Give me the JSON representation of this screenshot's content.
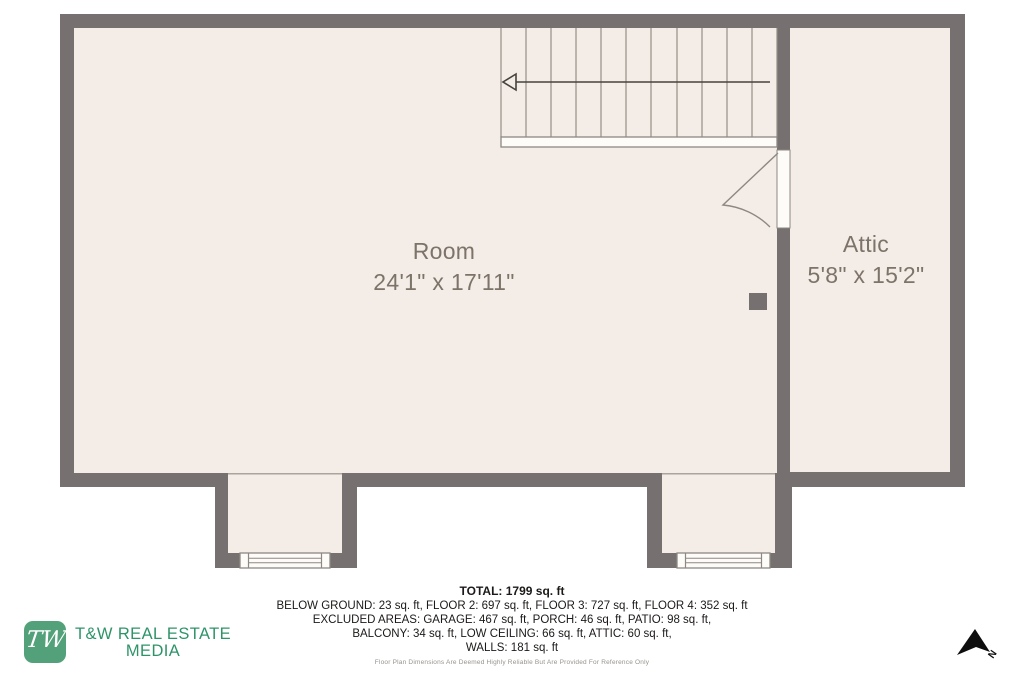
{
  "plan": {
    "room": {
      "name": "Room",
      "dims": "24'1\" x 17'11\""
    },
    "attic": {
      "name": "Attic",
      "dims": "5'8\" x 15'2\""
    }
  },
  "footer": {
    "total": "TOTAL: 1799 sq. ft",
    "line1": "BELOW GROUND: 23 sq. ft, FLOOR 2: 697 sq. ft, FLOOR 3: 727 sq. ft, FLOOR 4: 352 sq. ft",
    "line2": "EXCLUDED AREAS: GARAGE: 467 sq. ft, PORCH: 46 sq. ft, PATIO: 98 sq. ft,",
    "line3": "BALCONY: 34 sq. ft, LOW CEILING: 66 sq. ft, ATTIC: 60 sq. ft,",
    "line4": "WALLS: 181 sq. ft",
    "disclaimer": "Floor Plan Dimensions Are Deemed Highly Reliable But Are Provided For Reference Only"
  },
  "logo": {
    "monogram": "TW",
    "line1": "T&W REAL ESTATE",
    "line2": "MEDIA"
  },
  "compass": {
    "label": "N"
  },
  "colors": {
    "wall": "#767170",
    "floor": "#f4ede7",
    "line": "#8e8882",
    "accent_green_box": "#52a17a",
    "accent_green_text": "#2e9468",
    "label_text": "#7c7369"
  }
}
